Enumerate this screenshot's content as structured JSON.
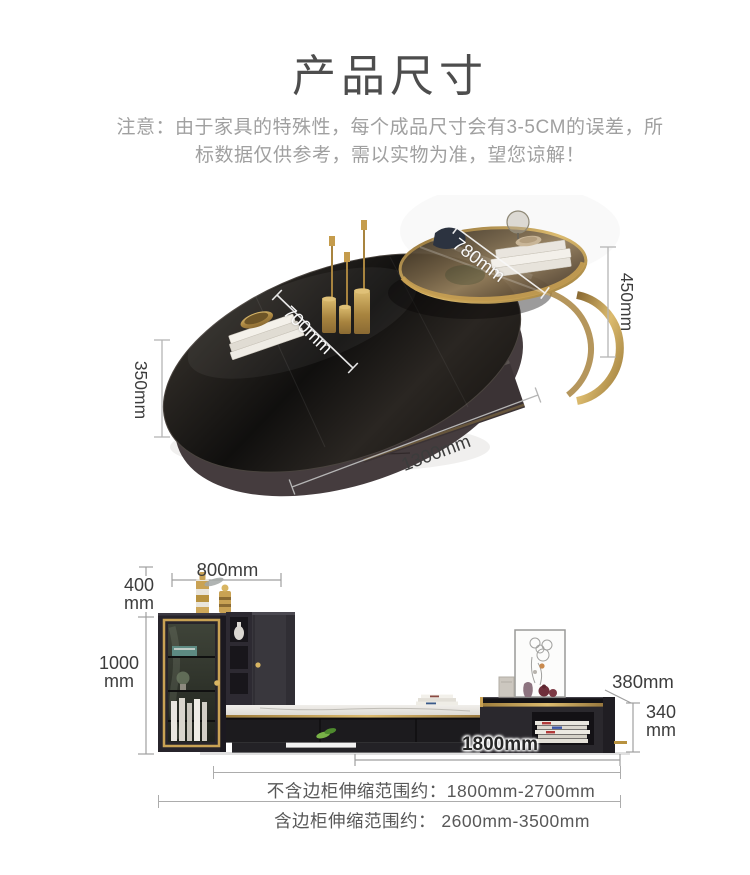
{
  "header": {
    "title": "产品尺寸",
    "notice1": "注意：由于家具的特殊性，每个成品尺寸会有3-5CM的误差，所",
    "notice2": "标数据仅供参考，需以实物为准，望您谅解！"
  },
  "coffee_table": {
    "side_table_diameter": "780mm",
    "table_top_width": "700mm",
    "side_table_height": "450mm",
    "table_height": "350mm",
    "table_length": "1300mm"
  },
  "tv_stand": {
    "top_cabinet_width": "800mm",
    "upper_height_value": "400",
    "upper_height_unit": "mm",
    "cabinet_height_value": "1000",
    "cabinet_height_unit": "mm",
    "side_cabinet_depth": "380mm",
    "side_cabinet_height_value": "340",
    "side_cabinet_height_unit": "mm",
    "base_length": "1800mm"
  },
  "footer": {
    "range_excluding_side": "不含边柜伸缩范围约：1800mm-2700mm",
    "range_including_side": "含边柜伸缩范围约： 2600mm-3500mm"
  },
  "colors": {
    "gold": "#c9a254",
    "dim_line": "#b5b5b5",
    "notice_text": "#a0a0a0"
  }
}
